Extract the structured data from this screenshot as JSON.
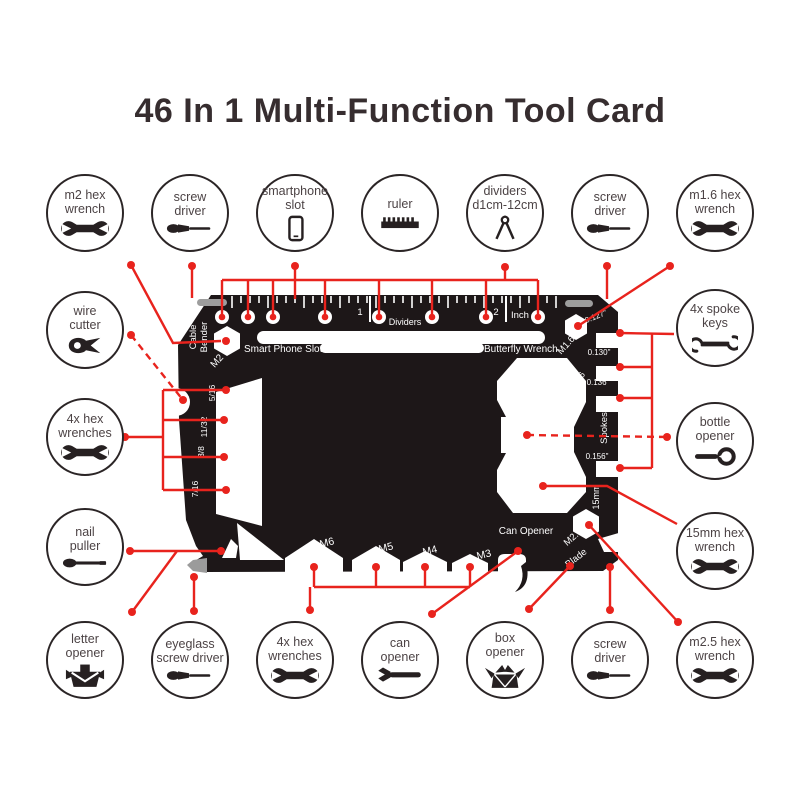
{
  "title": "46 In 1 Multi-Function Tool Card",
  "colors": {
    "accent_red": "#e8231d",
    "card_black": "#1d1718",
    "circle_stroke": "#2b2526",
    "label_text": "#4c4345",
    "gray_metal": "#9d9d9d"
  },
  "callouts": {
    "top": [
      {
        "id": "m2-hex-wrench",
        "lines": [
          "m2 hex",
          "wrench"
        ],
        "icon": "wrench-icon"
      },
      {
        "id": "screw-driver-top-left",
        "lines": [
          "screw",
          "driver"
        ],
        "icon": "screwdriver-icon"
      },
      {
        "id": "smartphone-slot",
        "lines": [
          "smartphone",
          "slot"
        ],
        "icon": "phone-icon"
      },
      {
        "id": "ruler",
        "lines": [
          "ruler"
        ],
        "icon": "ruler-icon"
      },
      {
        "id": "dividers",
        "lines": [
          "dividers",
          "d1cm-12cm"
        ],
        "icon": "dividers-icon"
      },
      {
        "id": "screw-driver-top-right",
        "lines": [
          "screw",
          "driver"
        ],
        "icon": "screwdriver-icon"
      },
      {
        "id": "m1-6-hex-wrench",
        "lines": [
          "m1.6 hex",
          "wrench"
        ],
        "icon": "wrench-icon"
      }
    ],
    "left": [
      {
        "id": "wire-cutter",
        "lines": [
          "wire",
          "cutter"
        ],
        "icon": "pliers-icon"
      },
      {
        "id": "4x-hex-wrenches-left",
        "lines": [
          "4x hex",
          "wrenches"
        ],
        "icon": "wrench-icon"
      },
      {
        "id": "nail-puller",
        "lines": [
          "nail",
          "puller"
        ],
        "icon": "nail-puller-icon"
      }
    ],
    "right": [
      {
        "id": "4x-spoke-keys",
        "lines": [
          "4x spoke",
          "keys"
        ],
        "icon": "spoke-key-icon"
      },
      {
        "id": "bottle-opener",
        "lines": [
          "bottle",
          "opener"
        ],
        "icon": "bottle-opener-icon"
      },
      {
        "id": "15mm-hex-wrench",
        "lines": [
          "15mm hex",
          "wrench"
        ],
        "icon": "wrench-icon"
      }
    ],
    "bottom": [
      {
        "id": "letter-opener",
        "lines": [
          "letter",
          "opener"
        ],
        "icon": "envelope-icon"
      },
      {
        "id": "eyeglass-screw-driver",
        "lines": [
          "eyeglass",
          "screw driver"
        ],
        "icon": "screwdriver-icon"
      },
      {
        "id": "4x-hex-wrenches-bottom",
        "lines": [
          "4x hex",
          "wrenches"
        ],
        "icon": "wrench-icon"
      },
      {
        "id": "can-opener",
        "lines": [
          "can",
          "opener"
        ],
        "icon": "can-opener-icon"
      },
      {
        "id": "box-opener",
        "lines": [
          "box",
          "opener"
        ],
        "icon": "box-opener-icon"
      },
      {
        "id": "screw-driver-bottom",
        "lines": [
          "screw",
          "driver"
        ],
        "icon": "screwdriver-icon"
      },
      {
        "id": "m2-5-hex-wrench",
        "lines": [
          "m2.5 hex",
          "wrench"
        ],
        "icon": "wrench-icon"
      }
    ]
  },
  "card": {
    "labels": {
      "cable": "Cable",
      "bender": "Bender",
      "m2": "M2",
      "smart_phone_slot": "Smart Phone Slot",
      "butterfly_wrench": "Butterfly Wrench",
      "dividers": "Dividers",
      "inch_1": "1",
      "inch_2": "2",
      "inch": "Inch",
      "m1_6": "M1.6",
      "d0127": "0.127\"",
      "d0130": "0.130\"",
      "d0136": "0.136\"",
      "d0156": "0.156\"",
      "s9_16": "9/16",
      "spokes": "Spokes",
      "mm15": "15mm",
      "m2_5": "M2.5",
      "blade": "Blade",
      "can_opener": "Can Opener",
      "m6": "M6",
      "m5": "M5",
      "m4": "M4",
      "m3": "M3",
      "s5_16": "5/16",
      "s11_32": "11/32",
      "s3_8": "3/8",
      "s7_16": "7/16"
    }
  }
}
